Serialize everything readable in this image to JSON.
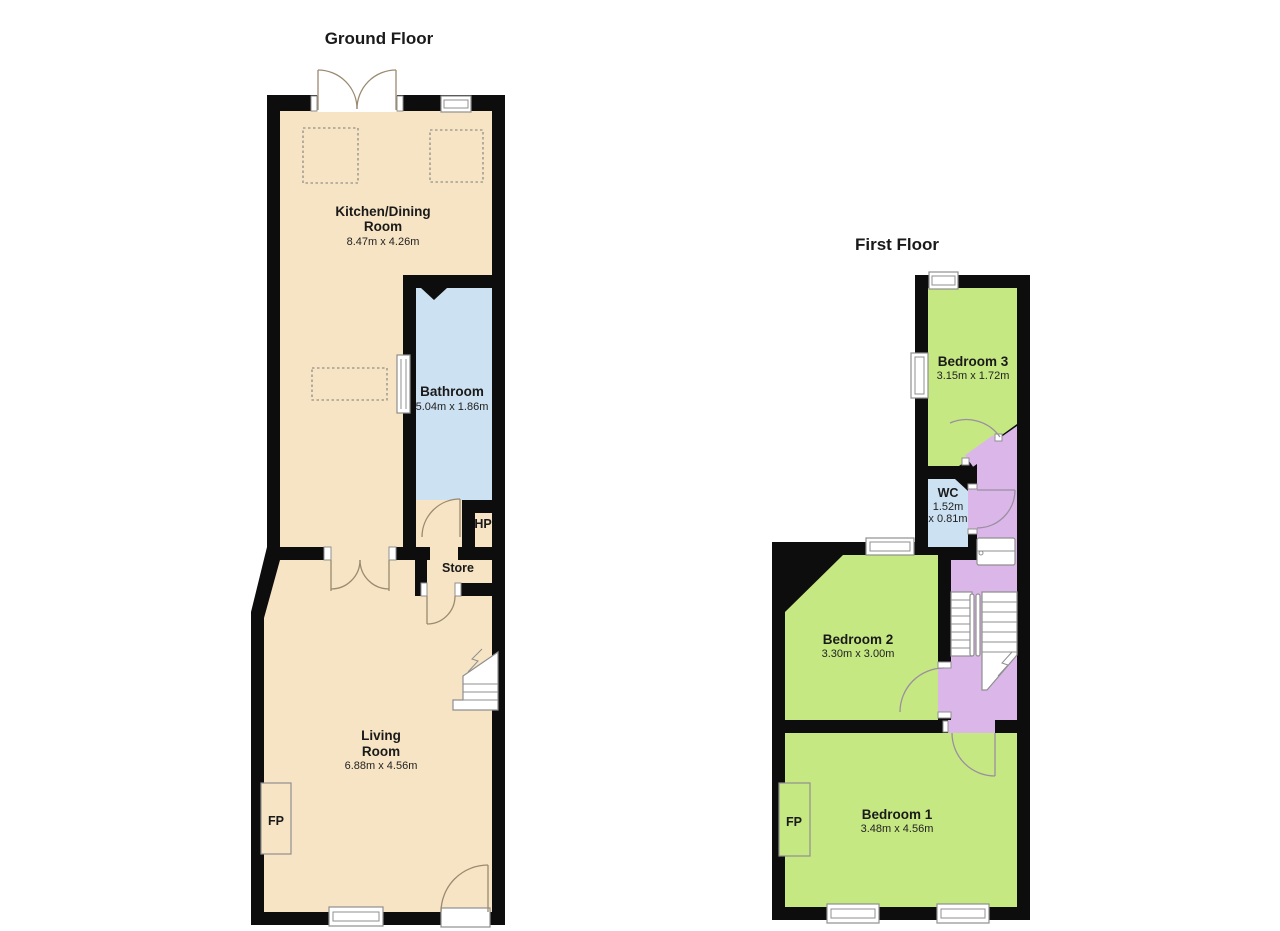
{
  "ground_floor": {
    "title": "Ground Floor",
    "kitchen": {
      "line1": "Kitchen/Dining",
      "line2": "Room",
      "dims": "8.47m x 4.26m"
    },
    "bathroom": {
      "name": "Bathroom",
      "dims": "5.04m x 1.86m"
    },
    "living": {
      "line1": "Living",
      "line2": "Room",
      "dims": "6.88m x 4.56m"
    },
    "hp_label": "HP",
    "store_label": "Store",
    "fireplace_label": "FP"
  },
  "first_floor": {
    "title": "First Floor",
    "bedroom3": {
      "name": "Bedroom 3",
      "dims": "3.15m x 1.72m"
    },
    "wc": {
      "name": "WC",
      "dims_line1": "1.52m",
      "dims_line2": "x 0.81m"
    },
    "bedroom2": {
      "name": "Bedroom 2",
      "dims": "3.30m x 3.00m"
    },
    "bedroom1": {
      "name": "Bedroom 1",
      "dims": "3.48m x 4.56m"
    },
    "fireplace_label": "FP"
  },
  "colors": {
    "wall": "#0d0d0d",
    "floor_cream": "#f7e4c4",
    "bathroom_blue": "#cce1f1",
    "bedroom_green": "#c6e883",
    "landing_purple": "#dbb6e9",
    "outline_gray": "#8f8f8f",
    "background": "#ffffff"
  }
}
